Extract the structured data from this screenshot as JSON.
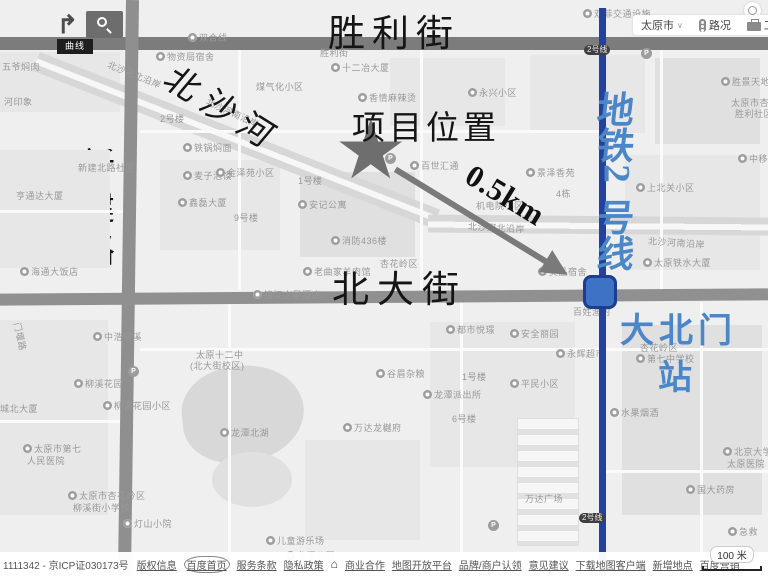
{
  "colors": {
    "metro_line": "#24429d",
    "station_fill": "#3d72c4",
    "station_border": "#1d3d8f",
    "blue_text": "#4a86c8",
    "arrow_gray": "#7a7a7a",
    "star_gray": "#6e6e6e"
  },
  "annotations": {
    "street_top": "胜利街",
    "river": "北沙河",
    "project": "项目位置",
    "distance": "0.5km",
    "street_left_chars": [
      "新",
      "建",
      "路"
    ],
    "street_mid": "北大街",
    "metro_chars": [
      "地",
      "铁",
      "2",
      "号",
      "线"
    ],
    "station_line1": "大北门",
    "station_line2": "站"
  },
  "toolbar": {
    "city": "太原市",
    "city_chevron": "∨",
    "traffic": "路况",
    "toolbox": "工具箱"
  },
  "tools": {
    "tooltip": "曲线"
  },
  "badges": [
    "2号线",
    "2号线"
  ],
  "footer": {
    "copyright": "1111342 - 京ICP证030173号",
    "links": [
      {
        "label": "版权信息"
      },
      {
        "label": "百度首页",
        "circled": true
      },
      {
        "label": "服务条款"
      },
      {
        "label": "隐私政策"
      },
      {
        "icon": "home"
      },
      {
        "label": "商业合作"
      },
      {
        "label": "地图开放平台"
      },
      {
        "label": "品牌/商户认领"
      },
      {
        "label": "意见建议"
      },
      {
        "label": "下载地图客户端"
      },
      {
        "label": "新增地点"
      },
      {
        "label": "百度营销"
      }
    ],
    "scale": "100 米"
  },
  "map": {
    "labels": [
      {
        "t": "五爷焖肉",
        "x": 2,
        "y": 60
      },
      {
        "t": "河印象",
        "x": 4,
        "y": 95
      },
      {
        "t": "物资局宿舍",
        "x": 156,
        "y": 50,
        "m": 1
      },
      {
        "t": "双合线",
        "x": 188,
        "y": 31,
        "m": 1
      },
      {
        "t": "双菲交通设施",
        "x": 583,
        "y": 7,
        "m": 1
      },
      {
        "t": "十二冶大厦",
        "x": 331,
        "y": 61,
        "m": 1
      },
      {
        "t": "胜利街",
        "x": 320,
        "y": 46
      },
      {
        "t": "胜景天地",
        "x": 721,
        "y": 75,
        "m": 1
      },
      {
        "t": "太原市杏花",
        "x": 731,
        "y": 96
      },
      {
        "t": "胜利社区",
        "x": 735,
        "y": 107
      },
      {
        "t": "永兴小区",
        "x": 468,
        "y": 86,
        "m": 1
      },
      {
        "t": "煤气化小区",
        "x": 256,
        "y": 80
      },
      {
        "t": "香情麻辣烫",
        "x": 358,
        "y": 91,
        "m": 1
      },
      {
        "t": "北沙河北沿岸",
        "x": 106,
        "y": 68,
        "rot": 22
      },
      {
        "t": "北沙河南沿岸",
        "x": 204,
        "y": 106,
        "rot": 25
      },
      {
        "t": "2号楼",
        "x": 160,
        "y": 112
      },
      {
        "t": "铁锅焖面",
        "x": 183,
        "y": 141,
        "m": 1
      },
      {
        "t": "新建北路社区",
        "x": 78,
        "y": 161
      },
      {
        "t": "麦子泡馍",
        "x": 183,
        "y": 169,
        "m": 1
      },
      {
        "t": "鑫磊大厦",
        "x": 178,
        "y": 196,
        "m": 1
      },
      {
        "t": "亨通达大厦",
        "x": 16,
        "y": 189
      },
      {
        "t": "金泽苑小区",
        "x": 216,
        "y": 166,
        "m": 1
      },
      {
        "t": "1号楼",
        "x": 298,
        "y": 174
      },
      {
        "t": "安记公寓",
        "x": 298,
        "y": 198,
        "m": 1
      },
      {
        "t": "9号楼",
        "x": 234,
        "y": 211
      },
      {
        "t": "百世汇通",
        "x": 410,
        "y": 159,
        "m": 1
      },
      {
        "t": "消防436楼",
        "x": 331,
        "y": 234,
        "m": 1
      },
      {
        "t": "景泽香苑",
        "x": 526,
        "y": 166,
        "m": 1
      },
      {
        "t": "4栋",
        "x": 556,
        "y": 187
      },
      {
        "t": "机电院小区",
        "x": 476,
        "y": 199
      },
      {
        "t": "北沙河北沿岸",
        "x": 468,
        "y": 221,
        "rot": 3
      },
      {
        "t": "上北关小区",
        "x": 636,
        "y": 181,
        "m": 1
      },
      {
        "t": "北沙河南沿岸",
        "x": 648,
        "y": 236,
        "rot": 4
      },
      {
        "t": "太原铁水大厦",
        "x": 643,
        "y": 256,
        "m": 1
      },
      {
        "t": "中移在线",
        "x": 738,
        "y": 152,
        "m": 1
      },
      {
        "t": "昊品宿舍",
        "x": 538,
        "y": 265,
        "m": 1
      },
      {
        "t": "老曲家羊肉馆",
        "x": 303,
        "y": 265,
        "m": 1
      },
      {
        "t": "海通大饭店",
        "x": 20,
        "y": 265,
        "m": 1
      },
      {
        "t": "锦江之星酒店",
        "x": 253,
        "y": 288,
        "m": 1
      },
      {
        "t": "杏花岭区",
        "x": 380,
        "y": 257
      },
      {
        "t": "杏花岭区",
        "x": 640,
        "y": 341
      },
      {
        "t": "第七中学校",
        "x": 636,
        "y": 352,
        "m": 1
      },
      {
        "t": "都市悦璟",
        "x": 446,
        "y": 323,
        "m": 1
      },
      {
        "t": "安全丽园",
        "x": 510,
        "y": 327,
        "m": 1
      },
      {
        "t": "百姓渔村",
        "x": 573,
        "y": 305
      },
      {
        "t": "永辉超市",
        "x": 556,
        "y": 347,
        "m": 1
      },
      {
        "t": "平民小区",
        "x": 510,
        "y": 377,
        "m": 1
      },
      {
        "t": "1号楼",
        "x": 462,
        "y": 370
      },
      {
        "t": "谷眉杂粮",
        "x": 376,
        "y": 367,
        "m": 1
      },
      {
        "t": "龙潭派出所",
        "x": 423,
        "y": 388,
        "m": 1
      },
      {
        "t": "6号楼",
        "x": 452,
        "y": 412
      },
      {
        "t": "万达龙樾府",
        "x": 343,
        "y": 421,
        "m": 1
      },
      {
        "t": "太原十二中",
        "x": 196,
        "y": 348
      },
      {
        "t": "(北大街校区)",
        "x": 190,
        "y": 359
      },
      {
        "t": "龙潭北湖",
        "x": 220,
        "y": 426,
        "m": 1
      },
      {
        "t": "中浩柳溪",
        "x": 93,
        "y": 330,
        "m": 1
      },
      {
        "t": "柳溪花园",
        "x": 74,
        "y": 377,
        "m": 1
      },
      {
        "t": "柳溪花园小区",
        "x": 103,
        "y": 399,
        "m": 1
      },
      {
        "t": "城北大厦",
        "x": 0,
        "y": 402
      },
      {
        "t": "太原市第七",
        "x": 23,
        "y": 442,
        "m": 1
      },
      {
        "t": "人民医院",
        "x": 27,
        "y": 454
      },
      {
        "t": "太原市杏花岭区",
        "x": 68,
        "y": 489,
        "m": 1
      },
      {
        "t": "柳溪街小学校",
        "x": 73,
        "y": 501
      },
      {
        "t": "灯山小院",
        "x": 123,
        "y": 517,
        "m": 1
      },
      {
        "t": "门堰路",
        "x": 6,
        "y": 330,
        "rot": 78
      },
      {
        "t": "万达广场",
        "x": 525,
        "y": 492
      },
      {
        "t": "水果烟酒",
        "x": 610,
        "y": 406,
        "m": 1
      },
      {
        "t": "北京大学第",
        "x": 723,
        "y": 445,
        "m": 1
      },
      {
        "t": "太原医院",
        "x": 727,
        "y": 457
      },
      {
        "t": "国大药房",
        "x": 686,
        "y": 483,
        "m": 1
      },
      {
        "t": "急救",
        "x": 728,
        "y": 525,
        "m": 1
      },
      {
        "t": "儿童游乐场",
        "x": 266,
        "y": 534,
        "m": 1
      },
      {
        "t": "龙潭公园",
        "x": 286,
        "y": 549,
        "m": 1
      }
    ],
    "parking": [
      {
        "x": 641,
        "y": 48
      },
      {
        "x": 128,
        "y": 366
      },
      {
        "x": 488,
        "y": 520
      },
      {
        "x": 385,
        "y": 153
      }
    ]
  }
}
